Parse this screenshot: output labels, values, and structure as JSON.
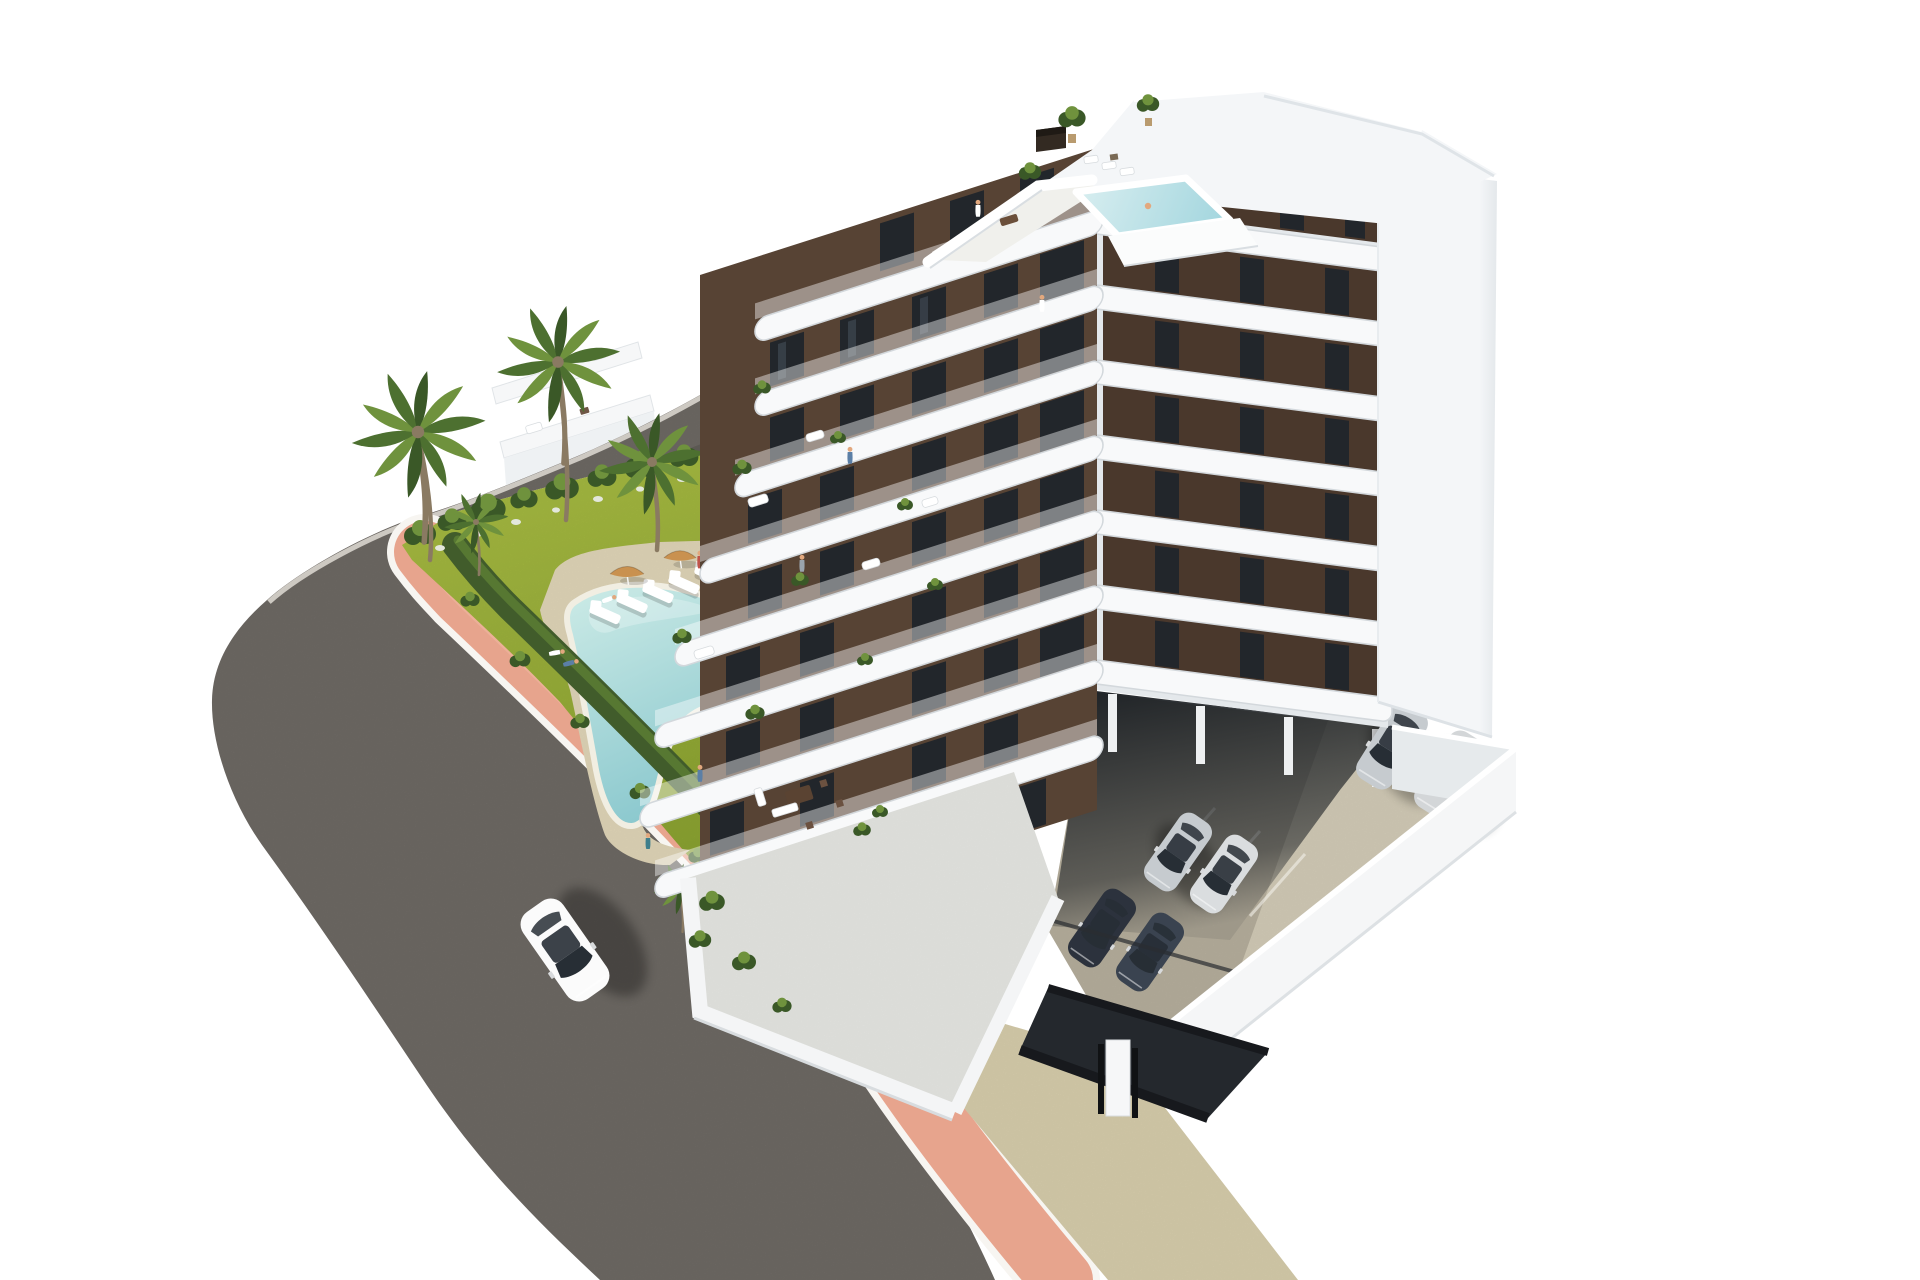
{
  "scene": {
    "image_type": "3d-architectural-render",
    "description": "Aerial 3D architectural rendering of a modern eight-storey white apartment building with dark brown facade panels and rounded white balconies. The rooftop has terraces, plants and a small turquoise plunge pool. A landscaped corner garden with a freeform turquoise swimming pool, five white sun loungers, two tan parasols and seven palm trees sits beside a curving asphalt road with a salmon-pink sidewalk. A white car drives on the road. To the right of the building is an open parking deck enclosed by white walls with silver cars, covered parking with more cars under the building, and a dark garage ramp.",
    "background": "#ffffff"
  },
  "colors": {
    "road": "#746f6a",
    "roadLight": "#807b75",
    "curb": "#d8d4cd",
    "sidewalkPink": "#e7a48d",
    "sidewalkPinkLight": "#f1b9a2",
    "curbWhite": "#f7f5f1",
    "hedge": "#415c2b",
    "hedgeLight": "#5d7f35",
    "grassTop": "#b3c748",
    "grassBottom": "#8fa832",
    "deck": "#e6dbbc",
    "pathBeige": "#dcd2b0",
    "poolLight": "#c9e9e5",
    "poolDeep": "#83c4cb",
    "poolRim": "#f1eee2",
    "roofPoolLight": "#d8eef0",
    "roofPoolDeep": "#9fd4dd",
    "palmA": "#4d7030",
    "palmB": "#6f923d",
    "palmC": "#3a5827",
    "trunk": "#8a7a62",
    "slabWhite": "#f8f9fa",
    "slabShade": "#d3d8dc",
    "buildingWhite": "#f4f6f8",
    "buildingShade": "#e4e8eb",
    "facadeBrown": "#574334",
    "facadeBrownDark": "#4a382c",
    "windowDark": "#22262b",
    "windowGlass": "#3c444d",
    "concreteSun": "#d9d2bd",
    "concreteShade": "#bcb4a2",
    "undercroft": "#1d2125",
    "rampDark": "#24282d",
    "rampWall": "#17191d",
    "carSilver": "#c6cbcf",
    "carDark": "#2c323d",
    "carWhite": "#fbfbfb",
    "glass": "#272e35",
    "skin": "#e2a87e",
    "umbrella": "#c9914f",
    "shadow": "#2f2f28"
  },
  "inventory": {
    "building": {
      "floors_visible": 8,
      "facade_materials": [
        "white-concrete",
        "brown-panels"
      ],
      "rooftop": {
        "plunge_pool": 1,
        "terraces": 2,
        "plants": 3,
        "chimney": 1,
        "people": 1
      },
      "balcony_people": 5,
      "balcony_plants": 9
    },
    "garden": {
      "swimming_pool": 1,
      "pool_shape": "freeform-kidney",
      "sun_loungers": 5,
      "umbrellas": 2,
      "palm_trees": 7,
      "perimeter_hedge": true,
      "people": 6
    },
    "road": {
      "surface": "asphalt",
      "sidewalk": "salmon-pink with white curbs",
      "cars_driving": 1
    },
    "parking": {
      "open_deck_cars": 2,
      "covered_cars": 4,
      "perimeter_walls": "white",
      "garage_ramp": true
    },
    "neighbor_terraces": 2
  }
}
